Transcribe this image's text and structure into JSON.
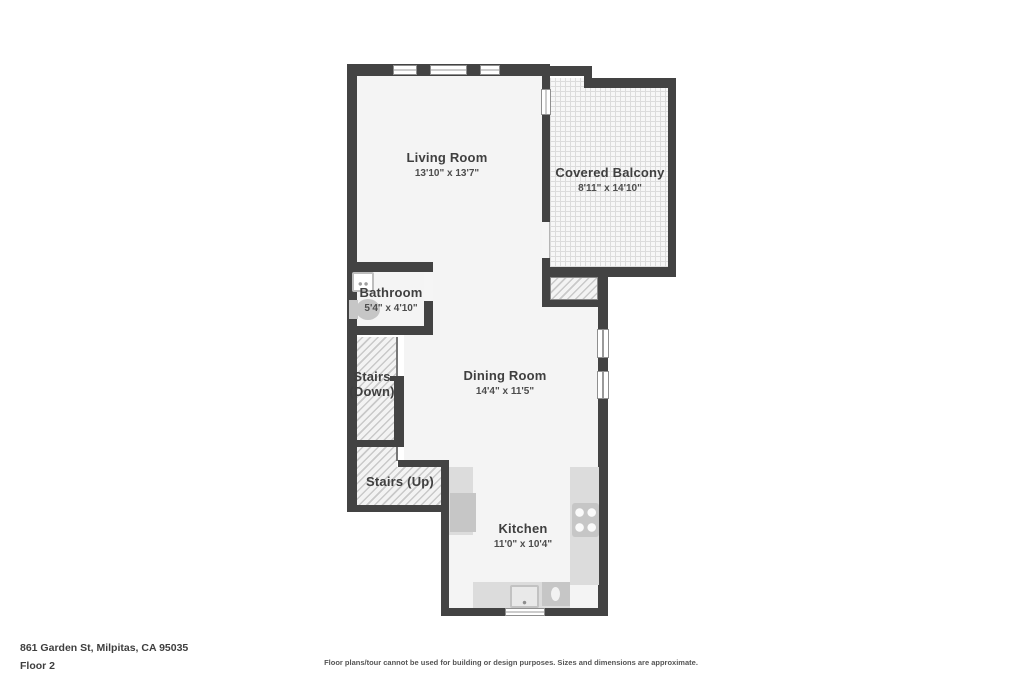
{
  "colors": {
    "wall": "#434343",
    "floor": "#f4f4f4",
    "counter": "#dcdcdc",
    "appliance": "#c6c6c6"
  },
  "rooms": {
    "living": {
      "name": "Living Room",
      "dims": "13'10\" x 13'7\""
    },
    "balcony": {
      "name": "Covered Balcony",
      "dims": "8'11\" x 14'10\""
    },
    "bathroom": {
      "name": "Bathroom",
      "dims": "5'4\" x 4'10\""
    },
    "stairs_down": {
      "name": "Stairs",
      "line2": "(Down)"
    },
    "stairs_up": {
      "name": "Stairs (Up)"
    },
    "dining": {
      "name": "Dining Room",
      "dims": "14'4\" x 11'5\""
    },
    "kitchen": {
      "name": "Kitchen",
      "dims": "11'0\" x 10'4\""
    }
  },
  "footer": {
    "address": "861 Garden St, Milpitas, CA 95035",
    "floor": "Floor 2",
    "disclaimer": "Floor plans/tour cannot be used for building or design purposes. Sizes and dimensions are approximate."
  }
}
